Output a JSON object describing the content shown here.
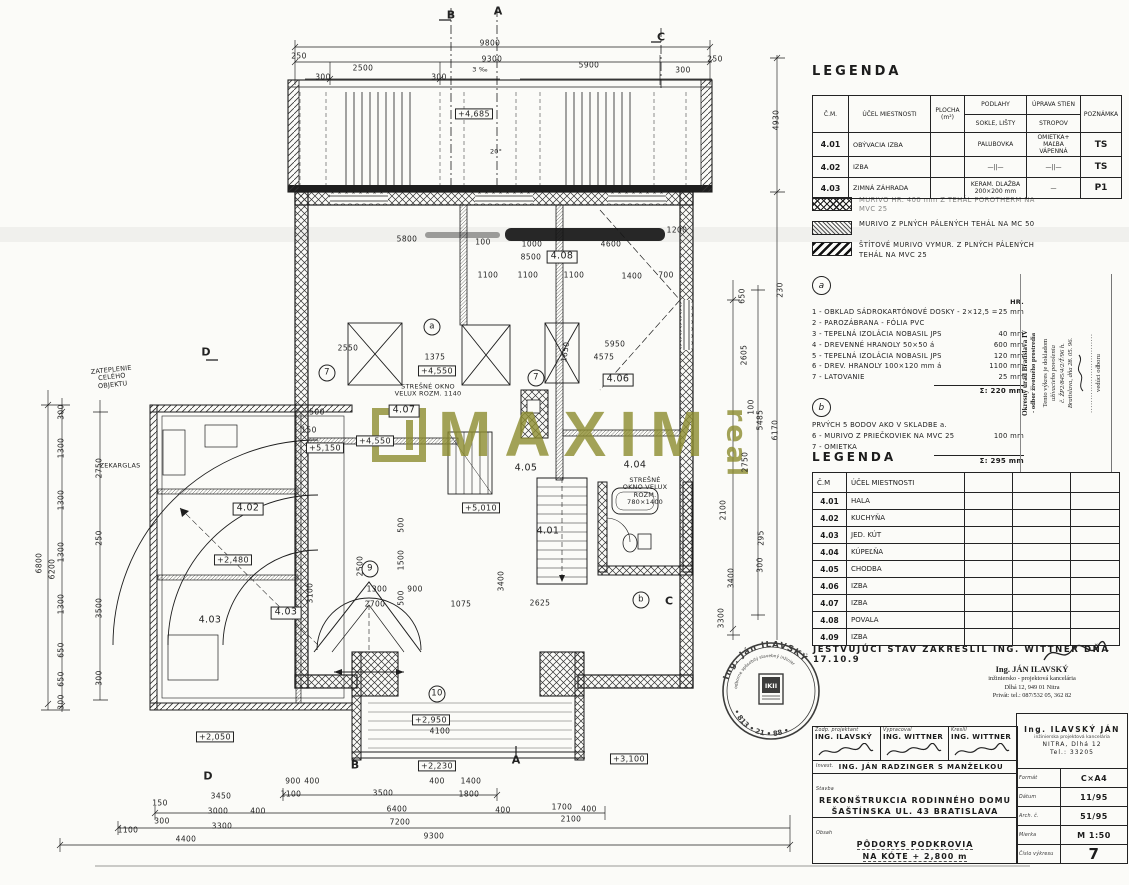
{
  "watermark": {
    "text": "MAXIM",
    "suffix": "real",
    "color": "#8d8d2f"
  },
  "legend1": {
    "title": "LEGENDA",
    "headers": {
      "c1": "Č.M.",
      "c2": "ÚČEL MIESTNOSTI",
      "c3": "PLOCHA\n(m²)",
      "c4a": "PODLAHY",
      "c4b": "SOKLE, LIŠTY",
      "c5a": "ÚPRAVA STIEN",
      "c5b": "STROPOV",
      "c6": "POZNÁMKA"
    },
    "rows": [
      {
        "cm": "4.01",
        "ucel": "OBÝVACIA IZBA",
        "plocha": "",
        "podlahy": "PALUBOVKA",
        "steny": "OMIETKA+ MAĽBA\nVÁPENNÁ",
        "pozn": "TS"
      },
      {
        "cm": "4.02",
        "ucel": "IZBA",
        "plocha": "",
        "podlahy": "—||—",
        "steny": "—||—",
        "pozn": "TS"
      },
      {
        "cm": "4.03",
        "ucel": "ZIMNÁ ZÁHRADA",
        "plocha": "",
        "podlahy": "KERAM. DLAŽBA\n200×200 mm",
        "steny": "—",
        "pozn": "P1"
      }
    ]
  },
  "wall_legend": [
    {
      "cls": "swatch-cross",
      "text": "MURIVO HR. 400 mm Z TEHÁL POROTHERM NA MVC 25"
    },
    {
      "cls": "swatch-fine",
      "text": "MURIVO Z PLNÝCH PÁLENÝCH TEHÁL NA MC 50"
    },
    {
      "cls": "swatch-diag",
      "text": "ŠTÍTOVÉ MURIVO VYMUR. Z PLNÝCH PÁLENÝCH TEHÁL NA MVC 25"
    }
  ],
  "notes_a": {
    "mark": "a",
    "col_header": "HR.",
    "items": [
      {
        "t": "1 - OBKLAD SÁDROKARTÓNOVÉ DOSKY - 2×12,5 =",
        "v": "25 mm"
      },
      {
        "t": "2 - PAROZÁBRANA - FÓLIA PVC",
        "v": ""
      },
      {
        "t": "3 - TEPELNÁ IZOLÁCIA NOBASIL JPS",
        "v": "40 mm"
      },
      {
        "t": "4 - DREVENNÉ HRANOLY 50×50 á",
        "v": "600 mm"
      },
      {
        "t": "5 - TEPELNÁ IZOLÁCIA NOBASIL JPS",
        "v": "120 mm"
      },
      {
        "t": "6 - DREV. HRANOLY 100×120 mm á",
        "v": "1100 mm"
      },
      {
        "t": "7 - LATOVANIE",
        "v": "25 mm"
      }
    ],
    "sum": "Σ: 220 mm"
  },
  "notes_b": {
    "mark": "b",
    "items": [
      {
        "t": "PRVÝCH 5 BODOV AKO V SKLADBE a.",
        "v": ""
      },
      {
        "t": "6 - MURIVO Z PRIEČKOVIEK NA MVC 25",
        "v": "100 mm"
      },
      {
        "t": "7 - OMIETKA",
        "v": ""
      }
    ],
    "sum": "Σ: 295 mm"
  },
  "legend2": {
    "title": "LEGENDA",
    "headers": [
      "Č.M",
      "ÚČEL MIESTNOSTI",
      "",
      "",
      ""
    ],
    "rows": [
      {
        "cm": "4.01",
        "ucel": "HALA"
      },
      {
        "cm": "4.02",
        "ucel": "KUCHYŇA"
      },
      {
        "cm": "4.03",
        "ucel": "JED. KÚT"
      },
      {
        "cm": "4.04",
        "ucel": "KÚPEĽŇA"
      },
      {
        "cm": "4.05",
        "ucel": "CHODBA"
      },
      {
        "cm": "4.06",
        "ucel": "IZBA"
      },
      {
        "cm": "4.07",
        "ucel": "IZBA"
      },
      {
        "cm": "4.08",
        "ucel": "POVALA"
      },
      {
        "cm": "4.09",
        "ucel": "IZBA"
      }
    ]
  },
  "approval_note": {
    "l1": "Okresný úrad Bratislava IV",
    "l2": "- odbor životného prostredia",
    "l3": "Tento výkres je dokladom",
    "l4": "užívacieho povolenia",
    "l5": "č. ŽP2/845/4/2/Ť/96 h.",
    "l6": "Bratislava, dňa 28. 05. 96.",
    "dots": "..............................",
    "l7": "vedúci odboru"
  },
  "statement": "JESTVUJÚCI STAV ZAKRESLIL ING. WITTNER DŇA 17.10.9",
  "contact": {
    "name": "Ing. JÁN ILAVSKÝ",
    "line2": "inžiniersko - projektová kancelária",
    "line3": "Dlhá 12, 949 01 Nitra",
    "line4": "Privát: tel.: 087/532 05, 362 82"
  },
  "round_stamp": {
    "name": "Ing. Ján ILAVSKÝ",
    "caption": "odborne spôsobilý stavebný inžinier",
    "number": "• 813 • 21 • 88 •",
    "shield": "IKII"
  },
  "titleblock": {
    "persons": [
      {
        "role": "Zodp. projektant",
        "name": "ING. ILAVSKÝ"
      },
      {
        "role": "Vypracoval",
        "name": "ING. WITTNER"
      },
      {
        "role": "Kreslil",
        "name": "ING. WITTNER"
      }
    ],
    "investor_label": "Invest.",
    "investor": "ING. JÁN RADZINGER S MANŽELKOU",
    "stavba_label": "Stavba",
    "stavba_line1": "REKONŠTRUKCIA RODINNÉHO DOMU",
    "stavba_line2": "ŠAŠTÍNSKA UL. 43 BRATISLAVA",
    "obsah_label": "Obsah",
    "obsah_line1": "PÔDORYS PODKROVIA",
    "obsah_line2": "NA KÓTE + 2,800 m",
    "firm": {
      "name": "Ing. ILAVSKÝ JÁN",
      "line2": "inžinierska projektová kancelária",
      "line3": "NITRA, Dlhá 12",
      "line4": "Tel.: 33205"
    },
    "info_rows": [
      {
        "label": "Formát",
        "value": "C×A4"
      },
      {
        "label": "Dátum",
        "value": "11/95"
      },
      {
        "label": "Arch. č.",
        "value": "51/95"
      },
      {
        "label": "Mierka",
        "value": "M 1:50"
      },
      {
        "label": "Číslo výkresu",
        "value": "7"
      }
    ]
  },
  "plan": {
    "labels": [
      {
        "t": "B",
        "x": 451,
        "y": 16,
        "k": "sec"
      },
      {
        "t": "A",
        "x": 498,
        "y": 12,
        "k": "sec"
      },
      {
        "t": "C",
        "x": 661,
        "y": 38,
        "k": "sec"
      },
      {
        "t": "D",
        "x": 206,
        "y": 353,
        "k": "sec"
      },
      {
        "t": "D",
        "x": 208,
        "y": 777,
        "k": "sec"
      },
      {
        "t": "B",
        "x": 355,
        "y": 766,
        "k": "sec"
      },
      {
        "t": "A",
        "x": 516,
        "y": 761,
        "k": "sec"
      },
      {
        "t": "C",
        "x": 669,
        "y": 602,
        "k": "sec"
      },
      {
        "t": "a",
        "x": 432,
        "y": 327,
        "k": "ref"
      },
      {
        "t": "7",
        "x": 327,
        "y": 373,
        "k": "ref"
      },
      {
        "t": "7",
        "x": 536,
        "y": 378,
        "k": "ref"
      },
      {
        "t": "9",
        "x": 370,
        "y": 569,
        "k": "ref"
      },
      {
        "t": "10",
        "x": 437,
        "y": 694,
        "k": "ref"
      },
      {
        "t": "b",
        "x": 641,
        "y": 600,
        "k": "ref"
      },
      {
        "t": "+4,685",
        "x": 474,
        "y": 114,
        "k": "elev"
      },
      {
        "t": "+4,550",
        "x": 437,
        "y": 371,
        "k": "elev"
      },
      {
        "t": "+4,550",
        "x": 375,
        "y": 441,
        "k": "elev"
      },
      {
        "t": "+5,150",
        "x": 325,
        "y": 448,
        "k": "elev"
      },
      {
        "t": "+5,010",
        "x": 481,
        "y": 508,
        "k": "elev"
      },
      {
        "t": "+2,480",
        "x": 233,
        "y": 560,
        "k": "elev"
      },
      {
        "t": "+2,950",
        "x": 431,
        "y": 720,
        "k": "elev"
      },
      {
        "t": "+2,230",
        "x": 437,
        "y": 766,
        "k": "elev"
      },
      {
        "t": "+3,100",
        "x": 629,
        "y": 759,
        "k": "elev"
      },
      {
        "t": "+2,050",
        "x": 215,
        "y": 737,
        "k": "elev"
      },
      {
        "t": "4.08",
        "x": 562,
        "y": 257,
        "k": "roombox"
      },
      {
        "t": "4.06",
        "x": 618,
        "y": 380,
        "k": "roombox"
      },
      {
        "t": "4.07",
        "x": 404,
        "y": 411,
        "k": "roombox"
      },
      {
        "t": "4.02",
        "x": 248,
        "y": 509,
        "k": "roombox"
      },
      {
        "t": "4.03",
        "x": 286,
        "y": 613,
        "k": "roombox"
      },
      {
        "t": "4.01",
        "x": 548,
        "y": 532,
        "k": "room"
      },
      {
        "t": "4.03",
        "x": 210,
        "y": 621,
        "k": "room"
      },
      {
        "t": "4.04",
        "x": 635,
        "y": 466,
        "k": "room"
      },
      {
        "t": "4.05",
        "x": 526,
        "y": 469,
        "k": "room"
      },
      {
        "t": "STREŠNÉ OKNO\nVELUX ROZM. 1140",
        "x": 428,
        "y": 391,
        "k": "note"
      },
      {
        "t": "STREŠNÉ\nOKNO VELUX\nROZM.\n780×1400",
        "x": 645,
        "y": 492,
        "k": "note"
      },
      {
        "t": "ZATEPLENIE\nCELÉHO\nOBJEKTU",
        "x": 112,
        "y": 378,
        "k": "note",
        "r": -6
      },
      {
        "t": "ZEKARGLAS",
        "x": 120,
        "y": 466,
        "k": "note"
      },
      {
        "t": "3 ‰",
        "x": 480,
        "y": 70,
        "k": "note"
      },
      {
        "t": "20°",
        "x": 496,
        "y": 152,
        "k": "note"
      },
      {
        "t": "9800",
        "x": 490,
        "y": 44
      },
      {
        "t": "9300",
        "x": 492,
        "y": 60
      },
      {
        "t": "250",
        "x": 299,
        "y": 57
      },
      {
        "t": "300",
        "x": 323,
        "y": 78
      },
      {
        "t": "2500",
        "x": 363,
        "y": 69
      },
      {
        "t": "300",
        "x": 439,
        "y": 78
      },
      {
        "t": "5900",
        "x": 589,
        "y": 66
      },
      {
        "t": "300",
        "x": 683,
        "y": 71
      },
      {
        "t": "250",
        "x": 715,
        "y": 60
      },
      {
        "t": "5800",
        "x": 407,
        "y": 240
      },
      {
        "t": "100",
        "x": 483,
        "y": 243
      },
      {
        "t": "1000",
        "x": 532,
        "y": 245
      },
      {
        "t": "4600",
        "x": 611,
        "y": 245
      },
      {
        "t": "1200",
        "x": 677,
        "y": 231
      },
      {
        "t": "8500",
        "x": 531,
        "y": 258
      },
      {
        "t": "1100",
        "x": 488,
        "y": 276
      },
      {
        "t": "1100",
        "x": 528,
        "y": 276
      },
      {
        "t": "1100",
        "x": 574,
        "y": 276
      },
      {
        "t": "1400",
        "x": 632,
        "y": 277
      },
      {
        "t": "700",
        "x": 666,
        "y": 276
      },
      {
        "t": "2550",
        "x": 348,
        "y": 349
      },
      {
        "t": "1375",
        "x": 435,
        "y": 358
      },
      {
        "t": "5950",
        "x": 615,
        "y": 345
      },
      {
        "t": "4575",
        "x": 604,
        "y": 358
      },
      {
        "t": "500",
        "x": 317,
        "y": 413
      },
      {
        "t": "150",
        "x": 309,
        "y": 431
      },
      {
        "t": "1300",
        "x": 377,
        "y": 590
      },
      {
        "t": "900",
        "x": 415,
        "y": 590
      },
      {
        "t": "2700",
        "x": 375,
        "y": 605
      },
      {
        "t": "1075",
        "x": 461,
        "y": 605
      },
      {
        "t": "2625",
        "x": 540,
        "y": 604
      },
      {
        "t": "4100",
        "x": 440,
        "y": 732
      },
      {
        "t": "1650",
        "x": 566,
        "y": 352,
        "r": -80
      },
      {
        "t": "500",
        "x": 402,
        "y": 525,
        "r": -90
      },
      {
        "t": "1500",
        "x": 402,
        "y": 560,
        "r": -90
      },
      {
        "t": "500",
        "x": 402,
        "y": 598,
        "r": -90
      },
      {
        "t": "2500",
        "x": 361,
        "y": 566,
        "r": -90
      },
      {
        "t": "3100",
        "x": 311,
        "y": 593,
        "r": -90
      },
      {
        "t": "3400",
        "x": 502,
        "y": 581,
        "r": -90
      },
      {
        "t": "900",
        "x": 293,
        "y": 782
      },
      {
        "t": "400",
        "x": 312,
        "y": 782
      },
      {
        "t": "400",
        "x": 437,
        "y": 782
      },
      {
        "t": "1400",
        "x": 471,
        "y": 782
      },
      {
        "t": "150",
        "x": 160,
        "y": 804
      },
      {
        "t": "3450",
        "x": 221,
        "y": 797
      },
      {
        "t": "1100",
        "x": 291,
        "y": 795
      },
      {
        "t": "3500",
        "x": 383,
        "y": 794
      },
      {
        "t": "1800",
        "x": 469,
        "y": 795
      },
      {
        "t": "300",
        "x": 162,
        "y": 822
      },
      {
        "t": "3000",
        "x": 218,
        "y": 812
      },
      {
        "t": "400",
        "x": 258,
        "y": 812
      },
      {
        "t": "6400",
        "x": 397,
        "y": 810
      },
      {
        "t": "400",
        "x": 503,
        "y": 811
      },
      {
        "t": "1700",
        "x": 562,
        "y": 808
      },
      {
        "t": "400",
        "x": 589,
        "y": 810
      },
      {
        "t": "1100",
        "x": 128,
        "y": 831
      },
      {
        "t": "3300",
        "x": 222,
        "y": 827
      },
      {
        "t": "7200",
        "x": 400,
        "y": 823
      },
      {
        "t": "2100",
        "x": 571,
        "y": 820
      },
      {
        "t": "4400",
        "x": 186,
        "y": 840
      },
      {
        "t": "9300",
        "x": 434,
        "y": 837
      },
      {
        "t": "300",
        "x": 62,
        "y": 412,
        "r": -90
      },
      {
        "t": "1300",
        "x": 62,
        "y": 448,
        "r": -90
      },
      {
        "t": "1300",
        "x": 62,
        "y": 500,
        "r": -90
      },
      {
        "t": "1300",
        "x": 62,
        "y": 552,
        "r": -90
      },
      {
        "t": "1300",
        "x": 62,
        "y": 604,
        "r": -90
      },
      {
        "t": "650",
        "x": 62,
        "y": 650,
        "r": -90
      },
      {
        "t": "650",
        "x": 62,
        "y": 679,
        "r": -90
      },
      {
        "t": "300",
        "x": 62,
        "y": 702,
        "r": -90
      },
      {
        "t": "6800",
        "x": 40,
        "y": 563,
        "r": -90
      },
      {
        "t": "6200",
        "x": 53,
        "y": 569,
        "r": -90
      },
      {
        "t": "2750",
        "x": 100,
        "y": 468,
        "r": -90
      },
      {
        "t": "250",
        "x": 100,
        "y": 538,
        "r": -90
      },
      {
        "t": "3500",
        "x": 100,
        "y": 608,
        "r": -90
      },
      {
        "t": "300",
        "x": 100,
        "y": 678,
        "r": -90
      },
      {
        "t": "4930",
        "x": 777,
        "y": 120,
        "r": -90
      },
      {
        "t": "230",
        "x": 781,
        "y": 290,
        "r": -90
      },
      {
        "t": "650",
        "x": 743,
        "y": 296,
        "r": -90
      },
      {
        "t": "2605",
        "x": 745,
        "y": 355,
        "r": -90
      },
      {
        "t": "100",
        "x": 752,
        "y": 407,
        "r": -90
      },
      {
        "t": "5485",
        "x": 761,
        "y": 420,
        "r": -90
      },
      {
        "t": "6170",
        "x": 776,
        "y": 430,
        "r": -90
      },
      {
        "t": "2750",
        "x": 746,
        "y": 462,
        "r": -90
      },
      {
        "t": "2100",
        "x": 724,
        "y": 510,
        "r": -90
      },
      {
        "t": "295",
        "x": 762,
        "y": 538,
        "r": -90
      },
      {
        "t": "300",
        "x": 761,
        "y": 565,
        "r": -90
      },
      {
        "t": "3400",
        "x": 732,
        "y": 578,
        "r": -90
      },
      {
        "t": "3300",
        "x": 722,
        "y": 618,
        "r": -90
      }
    ]
  }
}
